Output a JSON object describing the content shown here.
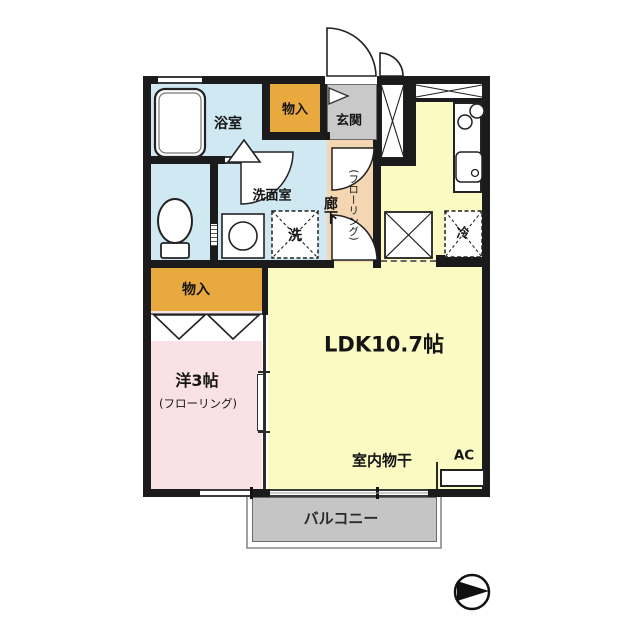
{
  "floorplan": {
    "rooms": {
      "bathroom": {
        "label": "浴室"
      },
      "storage_upper": {
        "label": "物入"
      },
      "entrance": {
        "label": "玄関"
      },
      "washroom": {
        "label": "洗面室"
      },
      "corridor": {
        "label": "廊下",
        "sublabel": "(フローリング)"
      },
      "ldk": {
        "label": "LDK10.7帖"
      },
      "western_room": {
        "label": "洋3帖",
        "sublabel": "(フローリング)"
      },
      "storage_lower": {
        "label": "物入"
      },
      "balcony": {
        "label": "バルコニー"
      }
    },
    "fixtures": {
      "laundry_pan_label": "洗",
      "refrigerator_label": "冷",
      "indoor_drying_label": "室内物干",
      "ac_label": "AC"
    },
    "colors": {
      "wall": "#1b1b1b",
      "wet_area_blue": "#cfe8f1",
      "storage_orange": "#e8a93e",
      "entrance_gray": "#c9c9c9",
      "corridor_peach": "#f4d7b2",
      "ldk_yellow": "#fafac2",
      "western_pink": "#f9e1e5",
      "balcony_gray": "#c5c5c5"
    }
  }
}
